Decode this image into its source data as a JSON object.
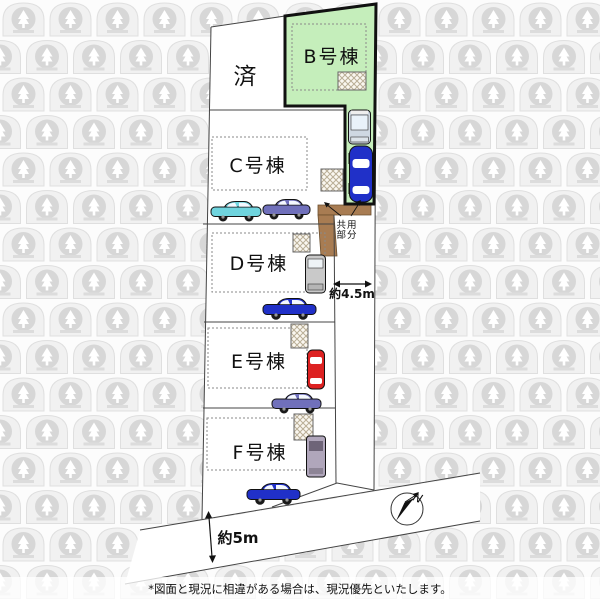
{
  "plots": {
    "sold_label": "済",
    "b_label": "B号棟",
    "c_label": "C号棟",
    "d_label": "D号棟",
    "e_label": "E号棟",
    "f_label": "F号棟"
  },
  "annotations": {
    "shared_area_line1": "共用",
    "shared_area_line2": "部分",
    "road_width_east": "約4.5m",
    "road_width_south": "約5m",
    "compass_north": "N"
  },
  "footer": {
    "disclaimer": "*図面と現況に相違がある場合は、現況優先といたします。"
  },
  "colors": {
    "plot_b_fill": "#c5eebb",
    "shared_drive_fill": "#a87c52",
    "car_blue": "#2030c8",
    "car_red": "#dd2222",
    "car_cyan": "#6fd4de",
    "car_purple": "#7070bb",
    "car_gray": "#c9c9c9",
    "car_lightvan": "#cfd8e2",
    "car_mauve": "#b0a6bb"
  }
}
